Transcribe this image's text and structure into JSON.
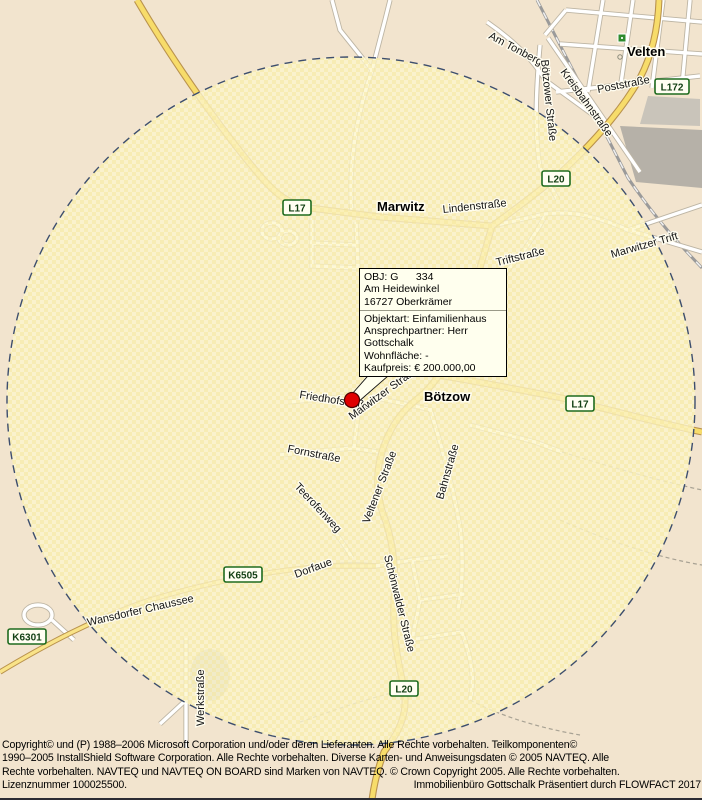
{
  "map": {
    "towns": [
      {
        "name": "Marwitz"
      },
      {
        "name": "Bötzow"
      },
      {
        "name": "Velten"
      }
    ],
    "road_signs": [
      {
        "label": "L17"
      },
      {
        "label": "L20"
      },
      {
        "label": "L172"
      },
      {
        "label": "L17"
      },
      {
        "label": "K6505"
      },
      {
        "label": "K6301"
      },
      {
        "label": "L20"
      }
    ],
    "streets": [
      {
        "name": "Lindenstraße"
      },
      {
        "name": "Triftstraße"
      },
      {
        "name": "Marwitzer Trift"
      },
      {
        "name": "Am Tonberg"
      },
      {
        "name": "Bötzower Straße"
      },
      {
        "name": "Kreisbahnstraße"
      },
      {
        "name": "Poststraße"
      },
      {
        "name": "Friedhofstraße"
      },
      {
        "name": "Marwitzer Straße"
      },
      {
        "name": "Fornstraße"
      },
      {
        "name": "Teerofenweg"
      },
      {
        "name": "Veltener Straße"
      },
      {
        "name": "Bahnstraße"
      },
      {
        "name": "Wansdorfer Chaussee"
      },
      {
        "name": "Dorfaue"
      },
      {
        "name": "Schönwalder Straße"
      },
      {
        "name": "Werkstraße"
      }
    ],
    "colors": {
      "outside_circle_bg": "#F2E4CE",
      "inside_circle_fill": "#FBF3C9",
      "road_yellow": "#F7DC6A",
      "road_casing": "#B9924D",
      "circle_dash": "#3D4E6E",
      "marker_red": "#E00000",
      "sign_green": "#1E6B1E"
    }
  },
  "marker_tooltip": {
    "title": "OBJ: G      334",
    "street": "Am Heidewinkel",
    "city": "16727 Oberkrämer",
    "objektart": "Objektart: Einfamilienhaus",
    "ansprechpartner": "Ansprechpartner: Herr Gottschalk",
    "wohnflaeche": "Wohnfläche: -",
    "kaufpreis": "Kaufpreis: € 200.000,00"
  },
  "footer": {
    "line1": "Copyright© und (P) 1988–2006 Microsoft Corporation und/oder deren Lieferanten. Alle Rechte vorbehalten. Teilkomponenten©",
    "line2": "1990–2005 InstallShield Software Corporation. Alle Rechte vorbehalten. Diverse Karten- und Anweisungsdaten © 2005 NAVTEQ. Alle",
    "line3": "Rechte vorbehalten. NAVTEQ und NAVTEQ ON BOARD sind Marken von NAVTEQ. © Crown Copyright 2005. Alle Rechte vorbehalten.",
    "line4_left": "Lizenznummer 100025500.",
    "line4_right": "Immobilienbüro Gottschalk  Präsentiert durch FLOWFACT 2017"
  }
}
